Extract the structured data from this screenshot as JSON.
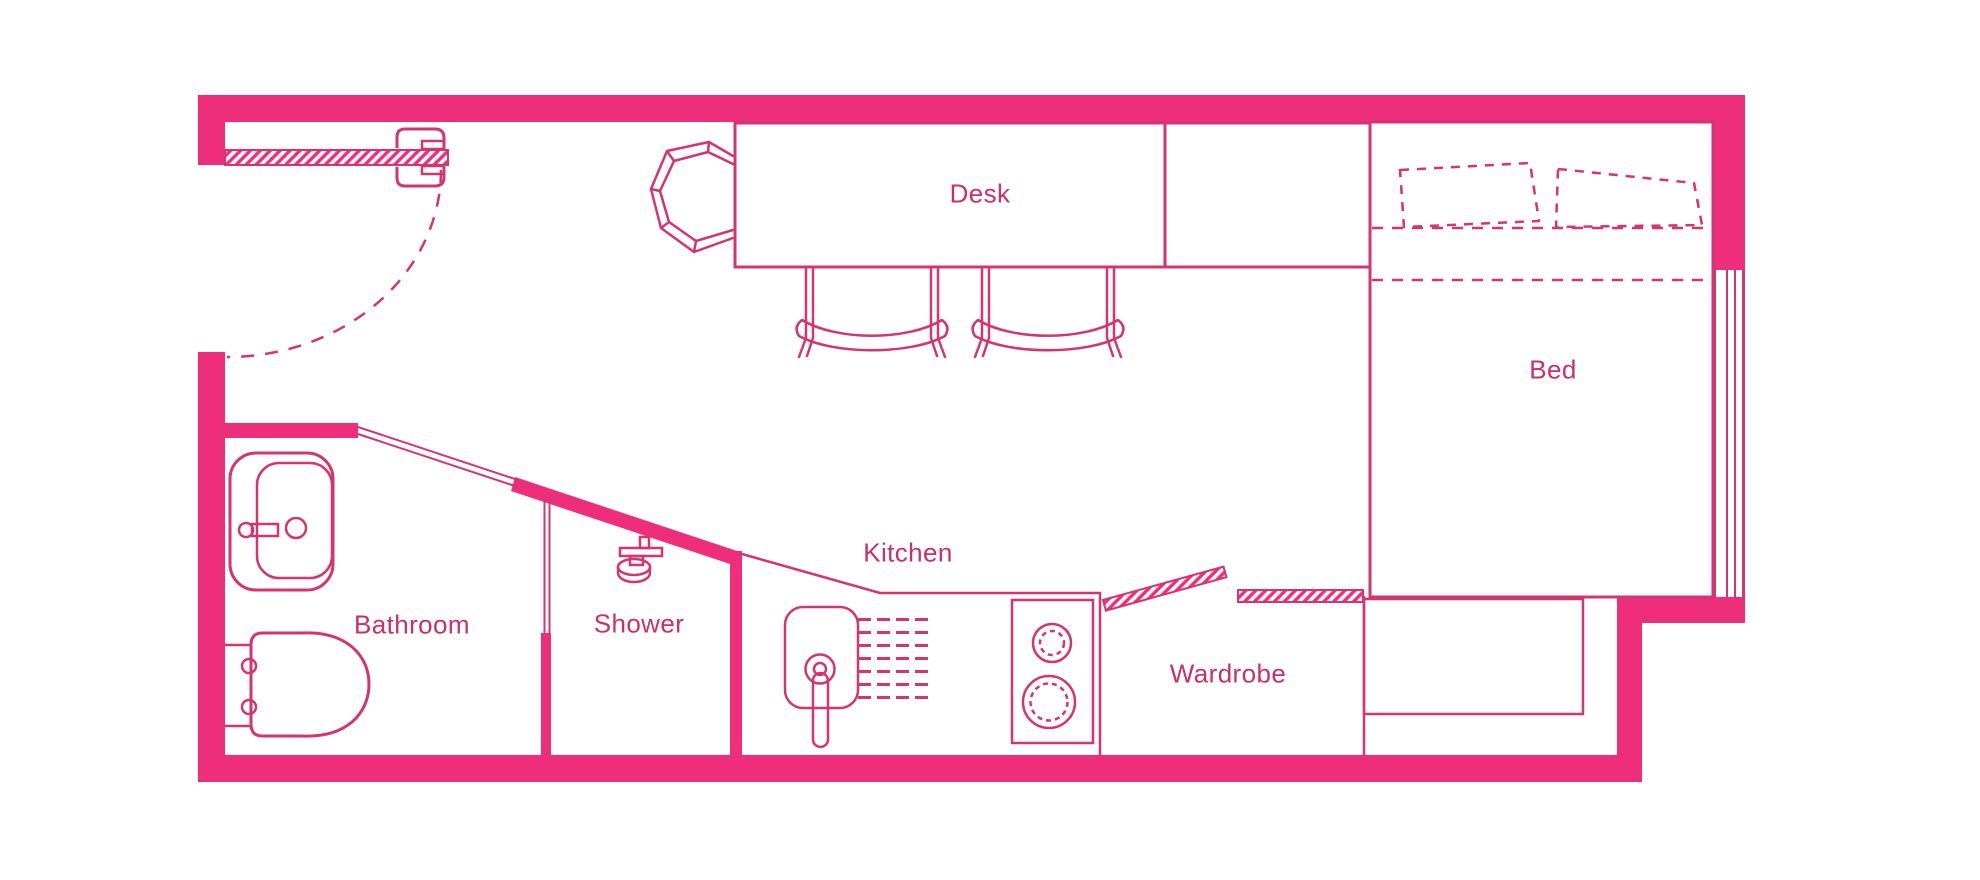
{
  "colors": {
    "wall": "#EE2D7B",
    "line": "#D23570",
    "text": "#C7316B",
    "bg": "#FFFFFF"
  },
  "floorplan": {
    "type": "studio-apartment-floor-plan",
    "rooms": {
      "desk": {
        "label": "Desk"
      },
      "bed": {
        "label": "Bed"
      },
      "bathroom": {
        "label": "Bathroom"
      },
      "shower": {
        "label": "Shower"
      },
      "kitchen": {
        "label": "Kitchen"
      },
      "wardrobe": {
        "label": "Wardrobe"
      }
    },
    "fixtures": [
      "entry-door",
      "door-swing-arc",
      "tub-chair",
      "desk-chairs",
      "bed-pillows",
      "window",
      "bed-bench",
      "wardrobe-sliding-doors",
      "stove-hob",
      "kitchen-sink",
      "drainboard-dashes",
      "shower-head",
      "bathroom-sink",
      "toilet"
    ]
  }
}
